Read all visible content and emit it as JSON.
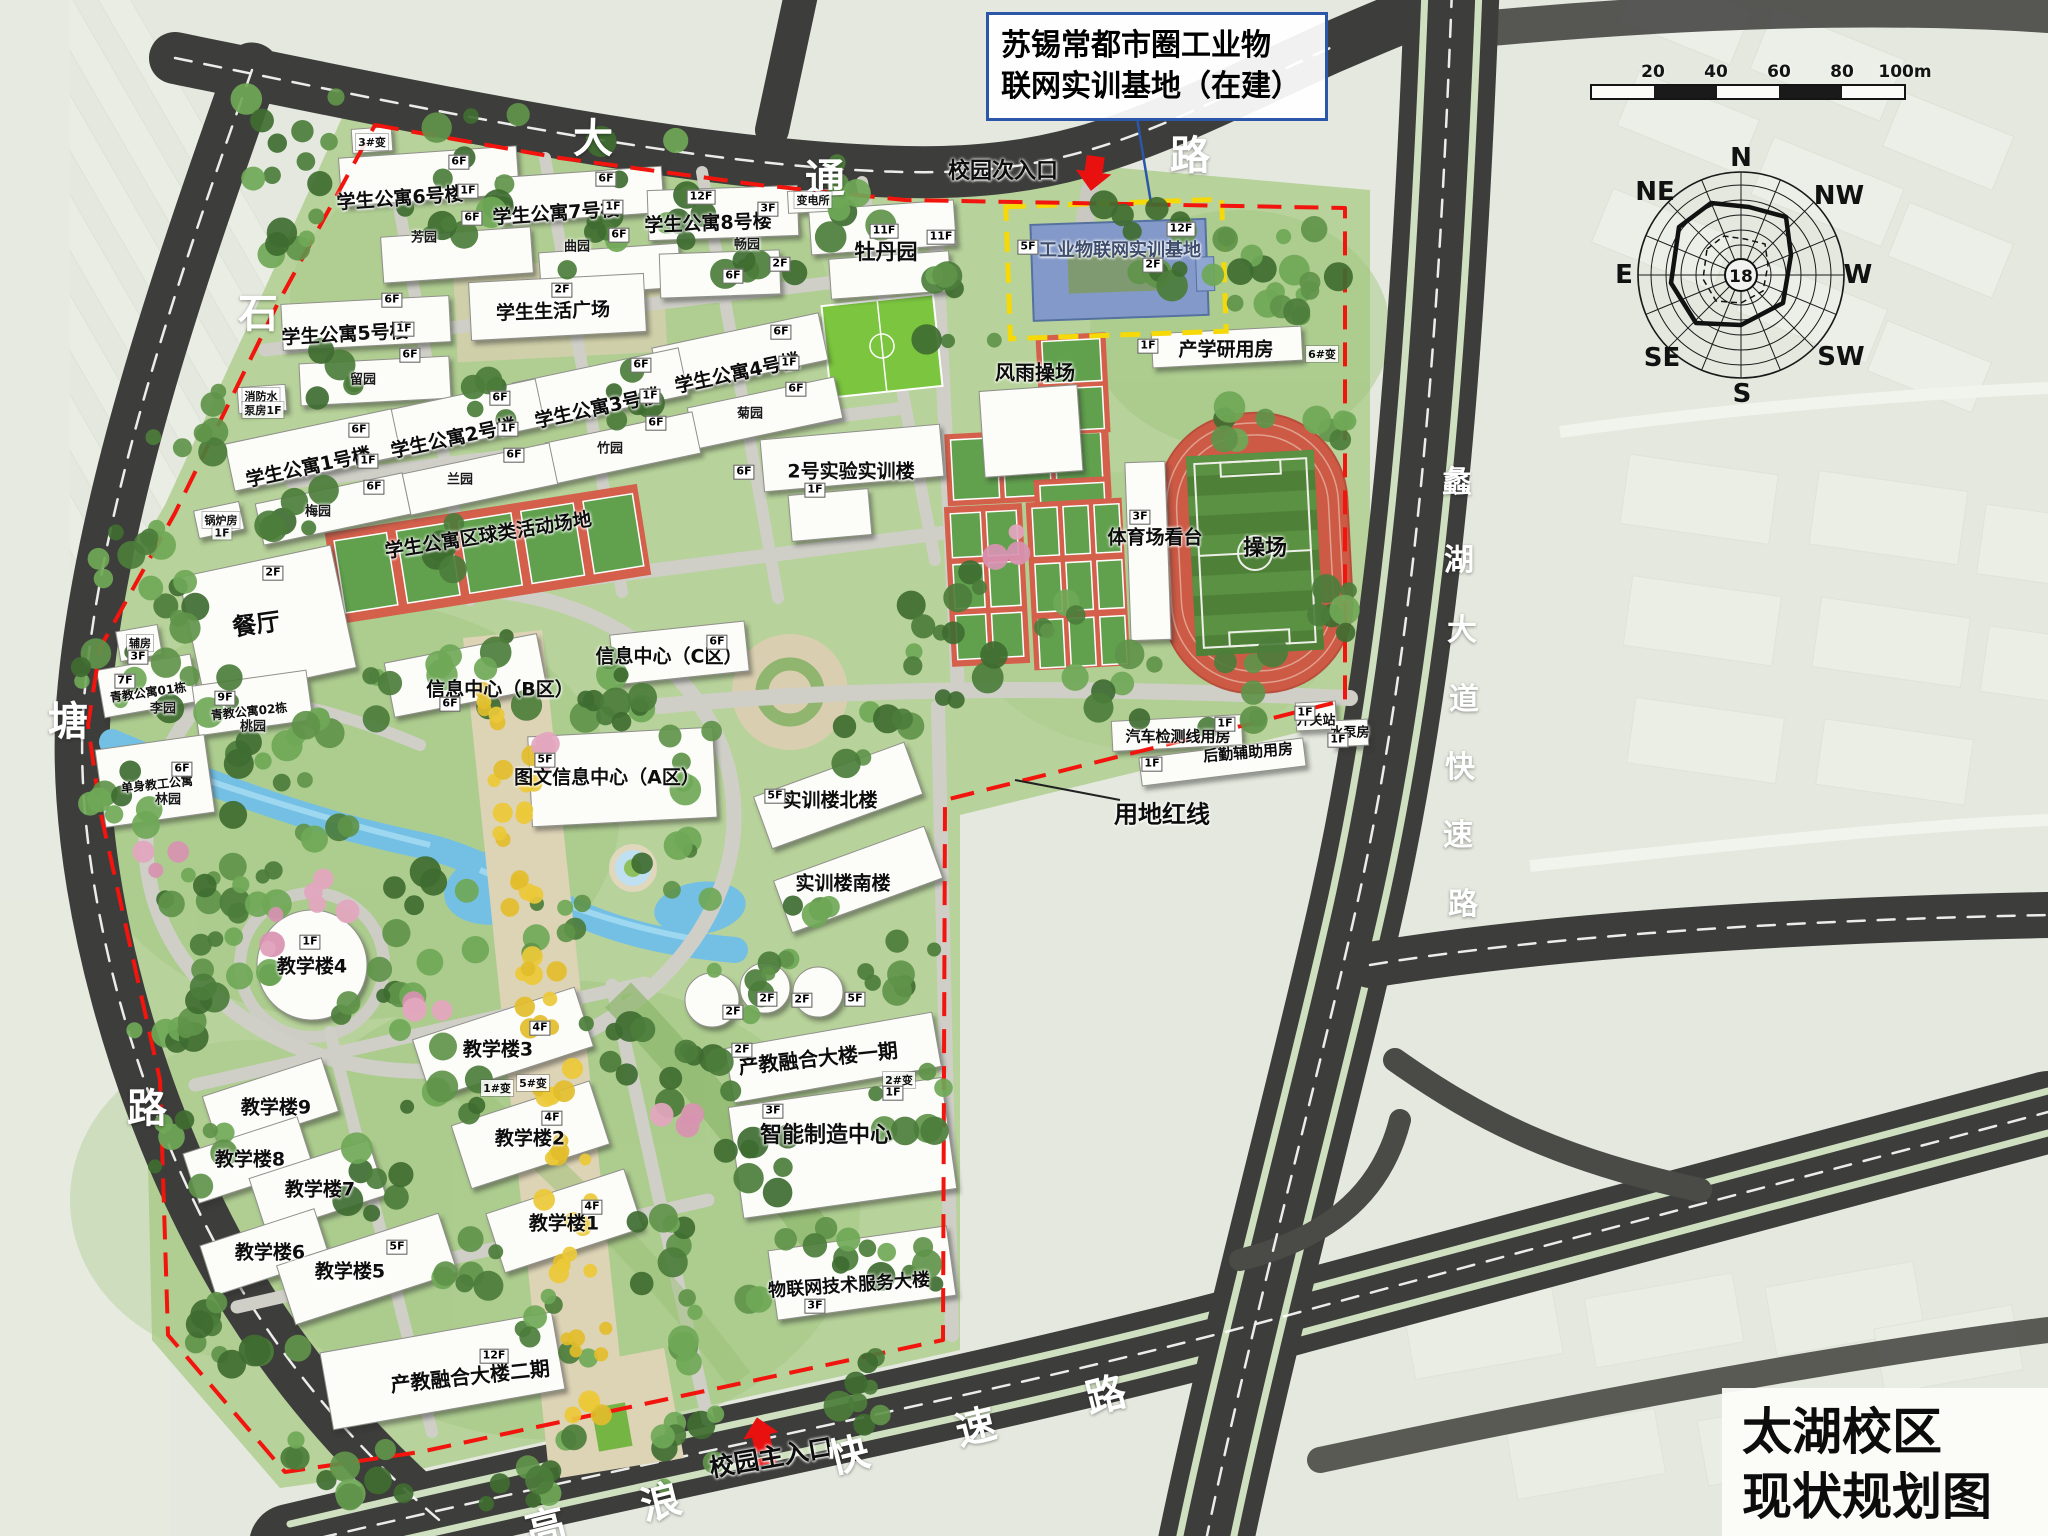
{
  "title_box": {
    "line1": "苏锡常都市圈工业物",
    "line2": "联网实训基地（在建）"
  },
  "map_title": {
    "line1": "太湖校区",
    "line2": "现状规划图"
  },
  "scale_bar": {
    "ticks": [
      "20",
      "40",
      "60",
      "80",
      "100m"
    ]
  },
  "compass": {
    "center_value": "18",
    "directions": {
      "n": "N",
      "nw": "NW",
      "w": "W",
      "sw": "SW",
      "s": "S",
      "se": "SE",
      "e": "E",
      "ne": "NE"
    }
  },
  "map_labels": [
    {
      "t": "学生公寓6号楼",
      "x": 400,
      "y": 197,
      "s": 19,
      "r": -4
    },
    {
      "t": "学生公寓7号楼",
      "x": 556,
      "y": 212,
      "s": 19,
      "r": -4
    },
    {
      "t": "学生公寓8号楼",
      "x": 708,
      "y": 222,
      "s": 19,
      "r": -2
    },
    {
      "t": "学生生活广场",
      "x": 553,
      "y": 310,
      "s": 19,
      "r": -2
    },
    {
      "t": "学生公寓5号楼",
      "x": 345,
      "y": 333,
      "s": 19,
      "r": -3
    },
    {
      "t": "学生公寓4号楼",
      "x": 737,
      "y": 372,
      "s": 19,
      "r": -12
    },
    {
      "t": "学生公寓3号楼",
      "x": 597,
      "y": 407,
      "s": 19,
      "r": -12
    },
    {
      "t": "学生公寓2号楼",
      "x": 453,
      "y": 437,
      "s": 19,
      "r": -12
    },
    {
      "t": "学生公寓1号楼",
      "x": 308,
      "y": 466,
      "s": 19,
      "r": -12
    },
    {
      "t": "餐厅",
      "x": 256,
      "y": 622,
      "s": 24,
      "r": -8
    },
    {
      "t": "牡丹园",
      "x": 886,
      "y": 251,
      "s": 21
    },
    {
      "t": "工业物联网实训基地",
      "x": 1120,
      "y": 249,
      "s": 18,
      "c": "#3d4d6b"
    },
    {
      "t": "产学研用房",
      "x": 1226,
      "y": 348,
      "s": 19
    },
    {
      "t": "风雨操场",
      "x": 1035,
      "y": 371,
      "s": 20
    },
    {
      "t": "体育场看台",
      "x": 1155,
      "y": 536,
      "s": 19
    },
    {
      "t": "操场",
      "x": 1265,
      "y": 546,
      "s": 22
    },
    {
      "t": "2号实验实训楼",
      "x": 851,
      "y": 470,
      "s": 19
    },
    {
      "t": "学生公寓区球类活动场地",
      "x": 488,
      "y": 534,
      "s": 19,
      "r": -9
    },
    {
      "t": "信息中心（B区）",
      "x": 500,
      "y": 688,
      "s": 19
    },
    {
      "t": "信息中心（C区）",
      "x": 669,
      "y": 655,
      "s": 19
    },
    {
      "t": "图文信息中心（A区）",
      "x": 607,
      "y": 776,
      "s": 19
    },
    {
      "t": "实训楼北楼",
      "x": 830,
      "y": 799,
      "s": 19
    },
    {
      "t": "实训楼南楼",
      "x": 843,
      "y": 882,
      "s": 19
    },
    {
      "t": "汽车检测线用房",
      "x": 1178,
      "y": 736,
      "s": 15
    },
    {
      "t": "后勤辅助用房",
      "x": 1248,
      "y": 752,
      "s": 15,
      "r": -5
    },
    {
      "t": "开关站",
      "x": 1316,
      "y": 719,
      "s": 13
    },
    {
      "t": "水泵房",
      "x": 1350,
      "y": 731,
      "s": 13
    },
    {
      "t": "用地红线",
      "x": 1162,
      "y": 812,
      "s": 24,
      "n": "boundary-label"
    },
    {
      "t": "教学楼4",
      "x": 312,
      "y": 965,
      "s": 19
    },
    {
      "t": "教学楼3",
      "x": 498,
      "y": 1048,
      "s": 19
    },
    {
      "t": "教学楼9",
      "x": 276,
      "y": 1106,
      "s": 19
    },
    {
      "t": "教学楼8",
      "x": 250,
      "y": 1158,
      "s": 19
    },
    {
      "t": "教学楼7",
      "x": 320,
      "y": 1188,
      "s": 19
    },
    {
      "t": "教学楼6",
      "x": 270,
      "y": 1251,
      "s": 19
    },
    {
      "t": "教学楼5",
      "x": 350,
      "y": 1270,
      "s": 19
    },
    {
      "t": "教学楼2",
      "x": 530,
      "y": 1137,
      "s": 19
    },
    {
      "t": "教学楼1",
      "x": 564,
      "y": 1222,
      "s": 19
    },
    {
      "t": "产教融合大楼一期",
      "x": 818,
      "y": 1057,
      "s": 20,
      "r": -6
    },
    {
      "t": "智能制造中心",
      "x": 826,
      "y": 1133,
      "s": 22
    },
    {
      "t": "物联网技术服务大楼",
      "x": 849,
      "y": 1284,
      "s": 18,
      "r": -4
    },
    {
      "t": "产教融合大楼二期",
      "x": 470,
      "y": 1375,
      "s": 20,
      "r": -6
    },
    {
      "t": "校园次入口",
      "x": 1003,
      "y": 169,
      "s": 22,
      "n": "secondary-entrance-label"
    },
    {
      "t": "校园主入口",
      "x": 771,
      "y": 1456,
      "s": 25,
      "r": -10,
      "n": "main-entrance-label"
    },
    {
      "t": "青教公寓01栋",
      "x": 148,
      "y": 692,
      "s": 12,
      "r": -8
    },
    {
      "t": "青教公寓02栋",
      "x": 249,
      "y": 711,
      "s": 12,
      "r": -6
    },
    {
      "t": "单身教工公寓",
      "x": 157,
      "y": 784,
      "s": 12,
      "r": -6
    }
  ],
  "road_labels": [
    {
      "t": "大",
      "x": 593,
      "y": 135
    },
    {
      "t": "通",
      "x": 825,
      "y": 175
    },
    {
      "t": "路",
      "x": 1190,
      "y": 152
    },
    {
      "t": "石",
      "x": 258,
      "y": 310
    },
    {
      "t": "塘",
      "x": 68,
      "y": 718
    },
    {
      "t": "路",
      "x": 147,
      "y": 1105
    },
    {
      "t": "高",
      "x": 545,
      "y": 1524,
      "r": -14
    },
    {
      "t": "浪",
      "x": 660,
      "y": 1499,
      "r": -14
    },
    {
      "t": "快",
      "x": 848,
      "y": 1452,
      "r": -14
    },
    {
      "t": "速",
      "x": 975,
      "y": 1424,
      "r": -14
    },
    {
      "t": "路",
      "x": 1105,
      "y": 1392,
      "r": -14
    },
    {
      "t": "蠡",
      "x": 1457,
      "y": 479,
      "s": 30
    },
    {
      "t": "湖",
      "x": 1459,
      "y": 557,
      "s": 30
    },
    {
      "t": "大",
      "x": 1462,
      "y": 627,
      "s": 30
    },
    {
      "t": "道",
      "x": 1464,
      "y": 696,
      "s": 30
    },
    {
      "t": "快",
      "x": 1460,
      "y": 764,
      "s": 30
    },
    {
      "t": "速",
      "x": 1458,
      "y": 832,
      "s": 30
    },
    {
      "t": "路",
      "x": 1463,
      "y": 901,
      "s": 30
    }
  ],
  "garden_labels": [
    {
      "t": "芳园",
      "x": 424,
      "y": 236
    },
    {
      "t": "曲园",
      "x": 577,
      "y": 245
    },
    {
      "t": "畅园",
      "x": 747,
      "y": 243
    },
    {
      "t": "留园",
      "x": 363,
      "y": 378
    },
    {
      "t": "梅园",
      "x": 318,
      "y": 510
    },
    {
      "t": "兰园",
      "x": 460,
      "y": 478
    },
    {
      "t": "竹园",
      "x": 610,
      "y": 447
    },
    {
      "t": "菊园",
      "x": 750,
      "y": 412
    },
    {
      "t": "李园",
      "x": 163,
      "y": 707
    },
    {
      "t": "桃园",
      "x": 253,
      "y": 725
    },
    {
      "t": "林园",
      "x": 168,
      "y": 798
    }
  ],
  "small_labels": [
    {
      "t": "3#变",
      "x": 372,
      "y": 142
    },
    {
      "t": "变电所",
      "x": 813,
      "y": 200
    },
    {
      "t": "6#变",
      "x": 1322,
      "y": 354
    },
    {
      "t": "2#变",
      "x": 899,
      "y": 1080
    },
    {
      "t": "1#变",
      "x": 497,
      "y": 1088
    },
    {
      "t": "5#变",
      "x": 533,
      "y": 1083
    },
    {
      "t": "消防水",
      "x": 261,
      "y": 396
    },
    {
      "t": "泵房1F",
      "x": 263,
      "y": 410
    },
    {
      "t": "锅炉房",
      "x": 221,
      "y": 520
    },
    {
      "t": "1F",
      "x": 222,
      "y": 533
    },
    {
      "t": "辅房",
      "x": 140,
      "y": 643
    }
  ],
  "floor_tags": [
    {
      "t": "6F",
      "x": 459,
      "y": 162
    },
    {
      "t": "1F",
      "x": 468,
      "y": 191
    },
    {
      "t": "6F",
      "x": 472,
      "y": 218
    },
    {
      "t": "6F",
      "x": 606,
      "y": 179
    },
    {
      "t": "1F",
      "x": 613,
      "y": 207
    },
    {
      "t": "6F",
      "x": 619,
      "y": 235
    },
    {
      "t": "12F",
      "x": 701,
      "y": 197
    },
    {
      "t": "3F",
      "x": 768,
      "y": 209
    },
    {
      "t": "2F",
      "x": 780,
      "y": 264
    },
    {
      "t": "6F",
      "x": 733,
      "y": 276
    },
    {
      "t": "2F",
      "x": 562,
      "y": 290
    },
    {
      "t": "6F",
      "x": 392,
      "y": 300
    },
    {
      "t": "1F",
      "x": 404,
      "y": 329
    },
    {
      "t": "6F",
      "x": 410,
      "y": 355
    },
    {
      "t": "6F",
      "x": 781,
      "y": 332
    },
    {
      "t": "1F",
      "x": 789,
      "y": 363
    },
    {
      "t": "6F",
      "x": 796,
      "y": 389
    },
    {
      "t": "6F",
      "x": 641,
      "y": 365
    },
    {
      "t": "1F",
      "x": 650,
      "y": 396
    },
    {
      "t": "6F",
      "x": 656,
      "y": 423
    },
    {
      "t": "6F",
      "x": 500,
      "y": 398
    },
    {
      "t": "1F",
      "x": 508,
      "y": 429
    },
    {
      "t": "6F",
      "x": 514,
      "y": 455
    },
    {
      "t": "6F",
      "x": 359,
      "y": 430
    },
    {
      "t": "1F",
      "x": 368,
      "y": 461
    },
    {
      "t": "6F",
      "x": 374,
      "y": 487
    },
    {
      "t": "11F",
      "x": 884,
      "y": 231
    },
    {
      "t": "11F",
      "x": 941,
      "y": 237
    },
    {
      "t": "12F",
      "x": 1181,
      "y": 229
    },
    {
      "t": "2F",
      "x": 1153,
      "y": 265
    },
    {
      "t": "5F",
      "x": 1028,
      "y": 247
    },
    {
      "t": "1F",
      "x": 1148,
      "y": 346
    },
    {
      "t": "3F",
      "x": 1140,
      "y": 517
    },
    {
      "t": "2F",
      "x": 273,
      "y": 573
    },
    {
      "t": "7F",
      "x": 125,
      "y": 681
    },
    {
      "t": "9F",
      "x": 225,
      "y": 698
    },
    {
      "t": "6F",
      "x": 182,
      "y": 769
    },
    {
      "t": "3F",
      "x": 138,
      "y": 657
    },
    {
      "t": "6F",
      "x": 717,
      "y": 642
    },
    {
      "t": "6F",
      "x": 450,
      "y": 704
    },
    {
      "t": "5F",
      "x": 545,
      "y": 760
    },
    {
      "t": "5F",
      "x": 775,
      "y": 796
    },
    {
      "t": "6F",
      "x": 744,
      "y": 472
    },
    {
      "t": "1F",
      "x": 815,
      "y": 490
    },
    {
      "t": "1F",
      "x": 1225,
      "y": 724
    },
    {
      "t": "1F",
      "x": 1152,
      "y": 764
    },
    {
      "t": "1F",
      "x": 1305,
      "y": 713
    },
    {
      "t": "1F",
      "x": 1338,
      "y": 740
    },
    {
      "t": "1F",
      "x": 310,
      "y": 942
    },
    {
      "t": "4F",
      "x": 540,
      "y": 1028
    },
    {
      "t": "4F",
      "x": 552,
      "y": 1118
    },
    {
      "t": "4F",
      "x": 592,
      "y": 1207
    },
    {
      "t": "5F",
      "x": 397,
      "y": 1247
    },
    {
      "t": "2F",
      "x": 733,
      "y": 1012
    },
    {
      "t": "2F",
      "x": 767,
      "y": 999
    },
    {
      "t": "2F",
      "x": 802,
      "y": 1000
    },
    {
      "t": "5F",
      "x": 855,
      "y": 999
    },
    {
      "t": "2F",
      "x": 742,
      "y": 1050
    },
    {
      "t": "3F",
      "x": 773,
      "y": 1111
    },
    {
      "t": "12F",
      "x": 494,
      "y": 1356
    },
    {
      "t": "3F",
      "x": 815,
      "y": 1306
    },
    {
      "t": "1F",
      "x": 893,
      "y": 1093
    }
  ]
}
